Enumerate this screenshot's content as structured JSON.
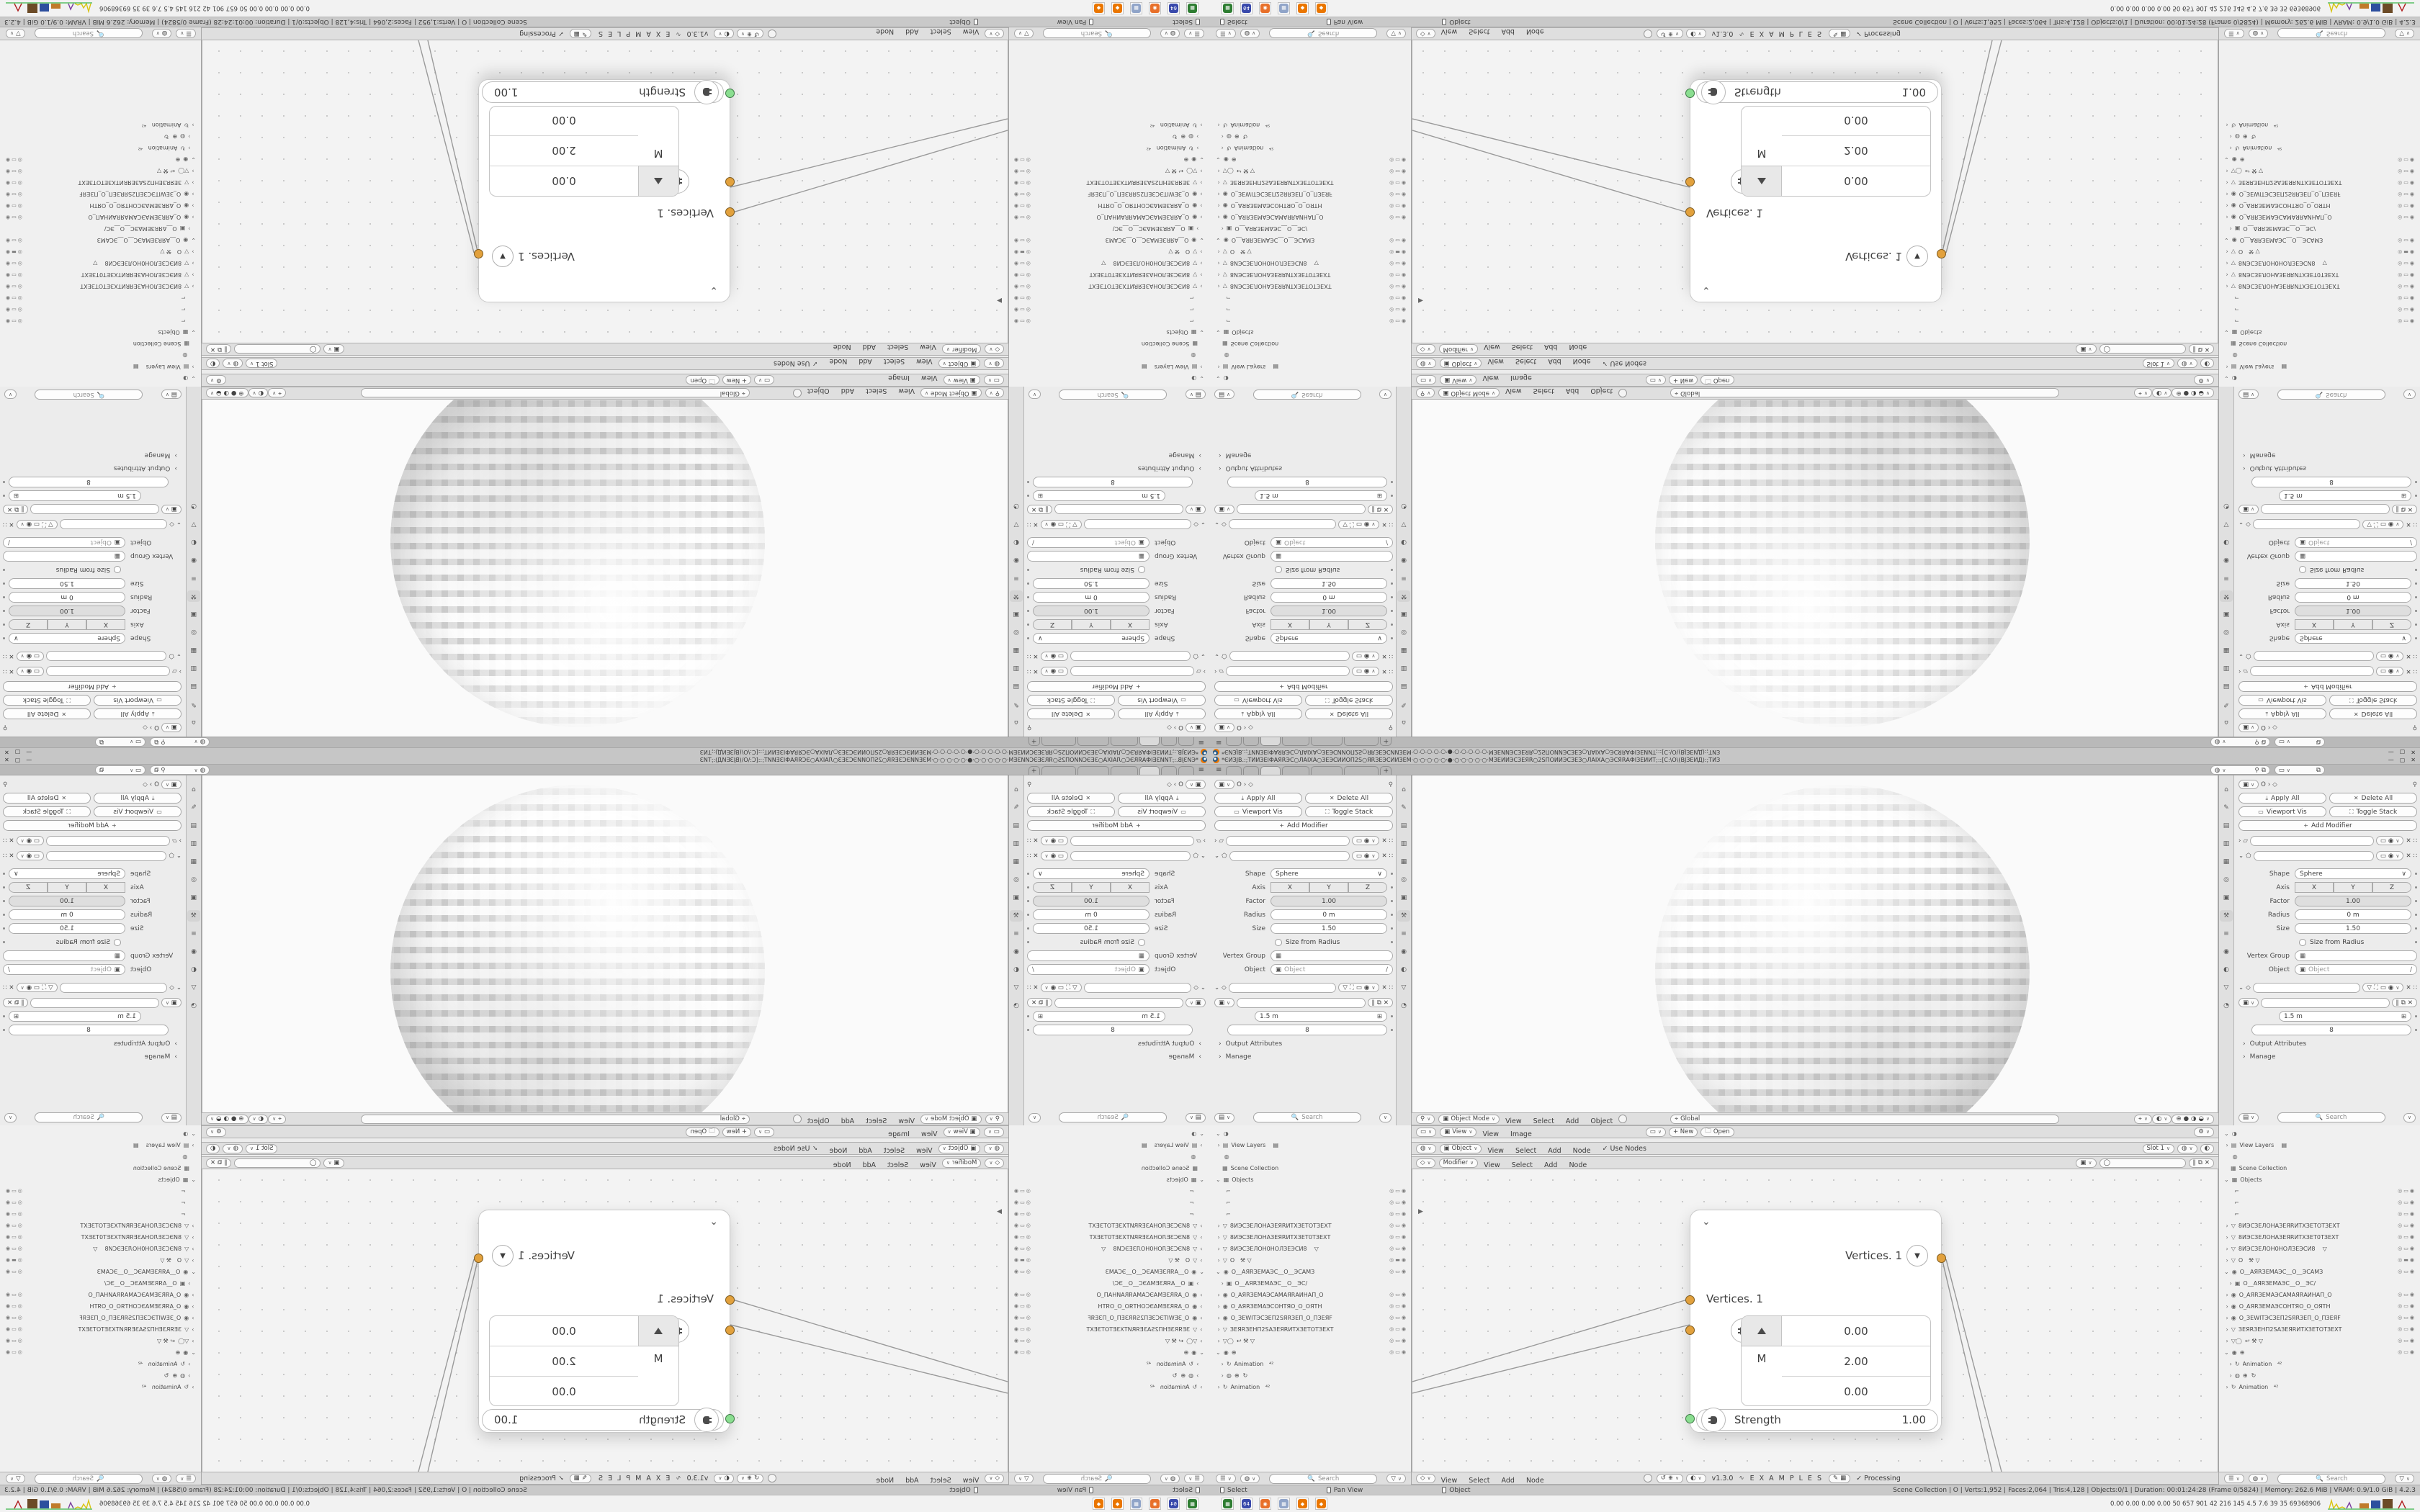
{
  "app": "Blender",
  "colors": {
    "accent_orange": "#ea7600",
    "socket_orange": "#e2a13d",
    "socket_green": "#8ade90",
    "title_bg": "#c6c6c6",
    "panel_bg": "#ececec",
    "taskbar_bg": "#f2f2f2"
  },
  "title_bar": {
    "star": "*",
    "text": "ЄИЗЈВ.:;ТИИЗЕІФАЯRЭС○ЛАІХА○ЗЕЭСИИОП2S○ЯRЗЕЭСИИЗЕМ·○·○·○·○·○·●·○·○·○·○·○·МЗЕИИЭСЗЕЯR○2SПОИИЭСЗЕЗ○ЛАІХА○ЭСЯRАФІЗЕИИТ;::[С:\\О\\(ВЈЗЕИД):;ТИЗ",
    "window_buttons": [
      "—",
      "▢",
      "✕"
    ]
  },
  "tabs_row": {
    "tabs": [
      {
        "style": "width:22px"
      },
      {
        "style": "width:22px"
      },
      {
        "style": "width:28px;background:#dadada"
      },
      {
        "style": "width:38px"
      },
      {
        "style": "width:44px"
      },
      {
        "style": "width:48px"
      }
    ],
    "add_label": "+"
  },
  "props": {
    "breadcrumb_icon": "▣",
    "breadcrumb_object": "O",
    "breadcrumb_chevron": "›",
    "pin_icon": "⚲",
    "apply_all": "Apply All",
    "delete_all": "Delete All",
    "viewport_vis": "Viewport Vis",
    "toggle_stack": "Toggle Stack",
    "add_modifier": "Add Modifier",
    "shape_label": "Shape",
    "shape_value": "Sphere",
    "axis_label": "Axis",
    "axis_options": [
      {
        "g": "X"
      },
      {
        "g": "Y"
      },
      {
        "g": "Z"
      }
    ],
    "factor_label": "Factor",
    "factor_value": "1.00",
    "radius_label": "Radius",
    "radius_value": "0 m",
    "size_label": "Size",
    "size_value": "1.50",
    "size_from_radius_label": "Size from Radius",
    "vertex_group_label": "Vertex Group",
    "object_label": "Object",
    "object_placeholder": "Object",
    "spacing_value": "1.5 m",
    "count_value": "8",
    "output_attributes": "Output Attributes",
    "manage": "Manage",
    "search_placeholder": "Search",
    "tab_icons": [
      {
        "g": "⌂"
      },
      {
        "g": "✎"
      },
      {
        "g": "▤"
      },
      {
        "g": "▥"
      },
      {
        "g": "▦"
      },
      {
        "g": "◎"
      },
      {
        "g": "▣"
      },
      {
        "g": "⚒",
        "style": "background:#d4d4d4"
      },
      {
        "g": "≡"
      },
      {
        "g": "◉"
      },
      {
        "g": "◐"
      },
      {
        "g": "▽"
      },
      {
        "g": "◔"
      }
    ]
  },
  "viewport_header": {
    "editor_icon": "⚲",
    "mode_icon": "▣",
    "mode": "Object Mode",
    "menus": [
      {
        "g": "View"
      },
      {
        "g": "Select"
      },
      {
        "g": "Add"
      },
      {
        "g": "Object"
      }
    ],
    "orientation_icon": "⌖",
    "orientation": "Global"
  },
  "image_header": {
    "editor_icon": "▭",
    "view_mode": "View",
    "menus": [
      {
        "g": "View"
      },
      {
        "g": "Image"
      }
    ],
    "new_button": "+ New",
    "open_button": "Open"
  },
  "shader_header": {
    "editor_icon": "◍",
    "target": "Object",
    "menus": [
      {
        "g": "View"
      },
      {
        "g": "Select"
      },
      {
        "g": "Add"
      },
      {
        "g": "Node"
      }
    ],
    "use_nodes_check": "✓",
    "use_nodes": "Use Nodes",
    "slot": "Slot 1"
  },
  "geo_header": {
    "editor_icon": "◇",
    "mode": "Modifier",
    "menus": [
      {
        "g": "View"
      },
      {
        "g": "Select"
      },
      {
        "g": "Add"
      },
      {
        "g": "Node"
      }
    ]
  },
  "node": {
    "collapse_icon": "⌄",
    "title": "Vertices. 1",
    "drop_icon": "▼",
    "input_label": "Vertices. 1",
    "vector_label": "M",
    "vector_values": [
      "0.00",
      "2.00",
      "0.00"
    ],
    "strength_label": "Strength",
    "strength_value": "1.00"
  },
  "node_footer": {
    "editor_icon": "◇",
    "menus": [
      {
        "g": "View"
      },
      {
        "g": "Select"
      },
      {
        "g": "Add"
      },
      {
        "g": "Node"
      }
    ],
    "version": "v1.3.0",
    "dna_icon": "∿",
    "examples": "E X A M P L E S",
    "processing_check": "✓",
    "processing": "Processing"
  },
  "outliner": {
    "rows": [
      {
        "pre": "⌄",
        "oi": "◑",
        "on": "",
        "orx": ""
      },
      {
        "pre": " ›",
        "oi": "▤",
        "on": "View Layers    ▤",
        "orx": ""
      },
      {
        "pre": "   ",
        "oi": "◍",
        "on": "",
        "orx": ""
      },
      {
        "pre": "  ",
        "oi": "▦",
        "on": "Scene Collection",
        "orx": ""
      },
      {
        "pre": "⌄",
        "oi": "▦",
        "on": "Objects",
        "orx": ""
      },
      {
        "pre": "    ",
        "oi": "⌐",
        "on": "",
        "orx": "◎▭◉"
      },
      {
        "pre": "    ",
        "oi": "⌐",
        "on": "",
        "orx": "◎▭◉"
      },
      {
        "pre": "    ",
        "oi": "⌐",
        "on": "",
        "orx": "◎▭◉"
      },
      {
        "pre": " ›",
        "oi": "▽",
        "on": "8ИЭСЗЕЛОНАЗЕЯRИТХЗЕТОТЗЕХТ",
        "orx": "◎▭◉"
      },
      {
        "pre": " ›",
        "oi": "▽",
        "on": "8ИЭСЗЕЛОНАЗЕЯRИТХЗЕТ0ТЗЕХТ",
        "orx": "◎▭◉"
      },
      {
        "pre": " ›",
        "oi": "▽",
        "on": "8ИЭСЗЕЛОН0НОЛЗЕЭСИ8    ▽",
        "orx": "◎▭◉"
      },
      {
        "pre": " ›",
        "oi": "▽",
        "on": "O   ⚒ ▽",
        "orx": "◎▬◉"
      },
      {
        "pre": "⌄",
        "oi": "◉",
        "on": "O__AЯRЗЕМАЭС__O__ЭСАМЗ",
        "orx": "◎▭◉"
      },
      {
        "pre": "   ›",
        "oi": "▣",
        "on": "O__AЯRЗЕМАЭС__O__ЭС/",
        "orx": ""
      },
      {
        "pre": " ›",
        "oi": "◉",
        "on": "O_AЯRЗЕМАЭСАМАЯRАИНАП_O",
        "orx": "◎▭◉"
      },
      {
        "pre": " ›",
        "oi": "◉",
        "on": "O_AЯRЗЕМАЭСОНТЯО_O_ОЯТН",
        "orx": "◎▭◉"
      },
      {
        "pre": " ›",
        "oi": "◉",
        "on": "O_ЗЕWІТЭСЗЕП2SЯRЗЕП_O_ПЗЕЯF",
        "orx": "◎▭◉"
      },
      {
        "pre": " ›",
        "oi": "▽",
        "on": "ЗЕЯRЗЕНП2SАЗЕЯRИТХЗЕТОТЗЕХТ",
        "orx": "◎▭◉"
      },
      {
        "pre": " ›",
        "oi": "▽◯",
        "on": "↩ ⚒ ▽",
        "orx": "◎▭◉"
      },
      {
        "pre": "⌄",
        "oi": "◉",
        "on": "⊕",
        "orx": "◎▭◉"
      },
      {
        "pre": "   ›",
        "oi": "↻",
        "on": "Animation   ⁴²",
        "orx": ""
      },
      {
        "pre": "   ›",
        "oi": "◍",
        "on": "⊕  ↻",
        "orx": ""
      },
      {
        "pre": " ›",
        "oi": "↻",
        "on": "Animation   ⁴²",
        "orx": ""
      }
    ],
    "filter_icon": "▽",
    "search_placeholder": "Search"
  },
  "status_bar": {
    "hints": [
      {
        "g": "Select"
      },
      {
        "g": "Pan View"
      },
      {
        "g": "Object"
      }
    ],
    "stats": "Scene Collection | O | Verts:1,952 | Faces:2,064 | Tris:4,128 | Objects:0/1 | Duration: 00:01:24:28 (Frame 0/5824) | Memory: 262.6 MiB | VRAM: 0.9/1.0 GiB | 4.2.3"
  },
  "taskbar": {
    "icons": [
      {
        "g": "▦",
        "style": "background:#2e7d32"
      },
      {
        "g": "64",
        "style": "background:#3949ab"
      },
      {
        "g": "◉",
        "style": "background:#e8702a"
      },
      {
        "g": "▦",
        "style": "background:#90a4c8"
      },
      {
        "g": "◆",
        "style": "background:#ea7600"
      },
      {
        "g": "◆",
        "style": "background:#ea7600"
      }
    ],
    "stats": "0.00 0.00 0.00 0.00   50   657   901   42   216   145   4.5   7.6   39   35   69368906"
  }
}
